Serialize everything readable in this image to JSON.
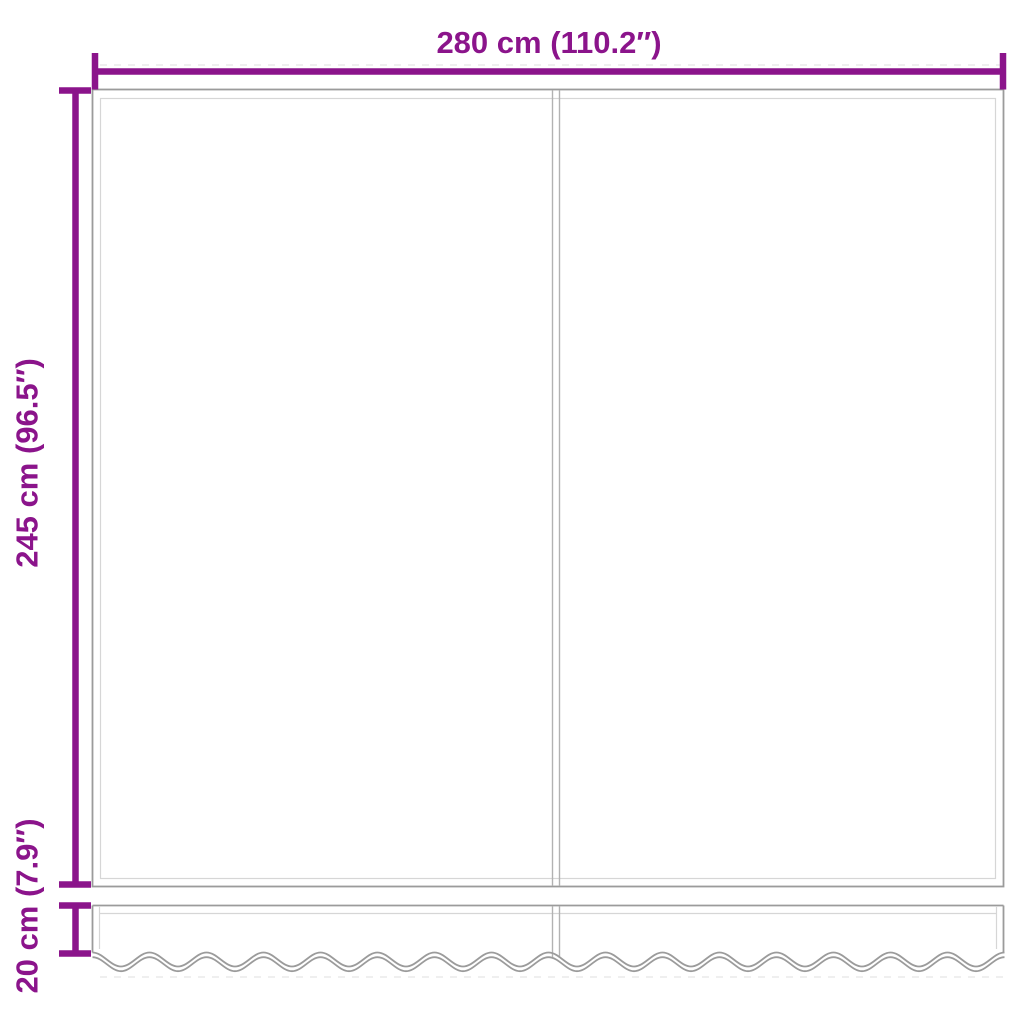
{
  "diagram": {
    "labels": {
      "width": "280 cm (110.2″)",
      "height": "245 cm (96.5″)",
      "valance_height": "20 cm (7.9″)"
    },
    "colors": {
      "dimension": "#8b148b",
      "outline": "#9b9b9b",
      "inner": "#d6d6d6",
      "seam": "#b2b2b2",
      "guide": "#e5e5e5",
      "background": "#ffffff"
    }
  }
}
